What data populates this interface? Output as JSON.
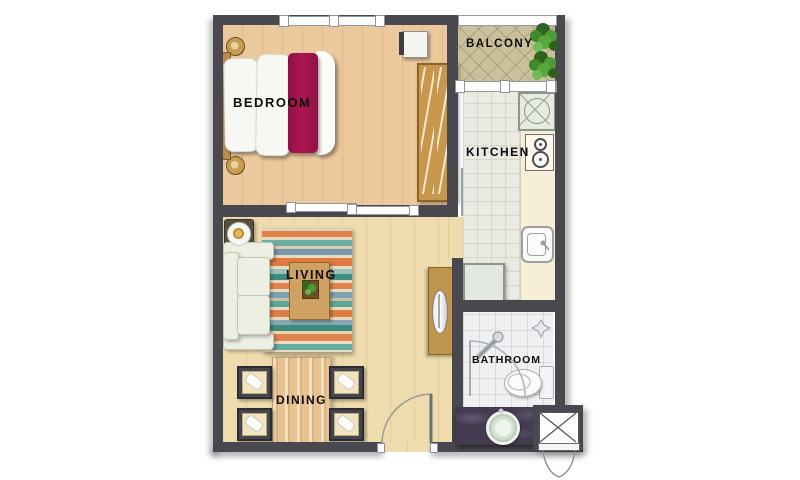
{
  "plan": {
    "title": "one-bedroom-apartment-floor-plan",
    "rooms": {
      "bedroom": {
        "label": "BEDROOM"
      },
      "balcony": {
        "label": "BALCONY"
      },
      "kitchen": {
        "label": "KITCHEN"
      },
      "living": {
        "label": "LIVING"
      },
      "dining": {
        "label": "DINING"
      },
      "bathroom": {
        "label": "BATHROOM"
      }
    },
    "furniture": [
      "bed",
      "pillows",
      "wardrobe",
      "nightstands",
      "bench",
      "sofa",
      "rug",
      "coffee-table",
      "tv-console",
      "side-table",
      "dining-table",
      "chairs",
      "counter",
      "washer",
      "stove",
      "sink",
      "fridge",
      "toilet",
      "shower",
      "vanity-basin",
      "balcony-plant",
      "ac-ledge"
    ]
  },
  "colors": {
    "wall": "#48484e",
    "bedroom-floor": "#ecc99d",
    "living-floor": "#efdcae",
    "kitchen-floor": "#e9ebe2",
    "balcony-floor": "#ccbf9c",
    "bathroom-floor": "#eef0f2",
    "counter": "#f7eed8",
    "wood": "#c6974d",
    "wood-dark": "#8a6426",
    "bed-throw": "#a3134e",
    "bedding": "#6f6154",
    "sofa": "#edefe2",
    "vanity": "#443b50",
    "plant": "#3c7d2f"
  }
}
